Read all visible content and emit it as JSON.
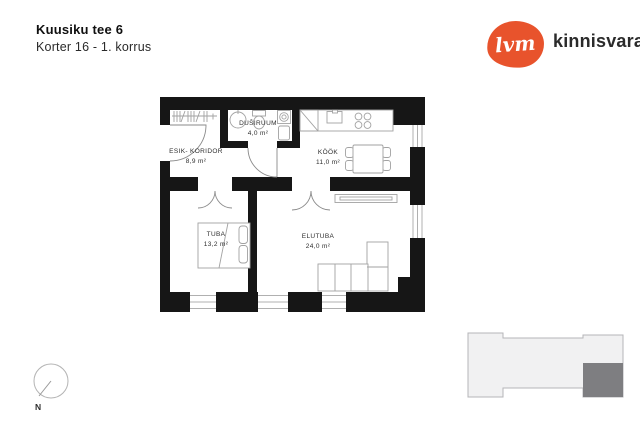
{
  "header": {
    "title": "Kuusiku tee 6",
    "subtitle": "Korter 16 - 1. korrus"
  },
  "logo": {
    "mark": "lvm",
    "brand": "kinnisvara",
    "color": "#e8532c"
  },
  "floor_plan": {
    "rooms": [
      {
        "name": "ESIK- KORIDOR",
        "area": "8,9 m²"
      },
      {
        "name": "DUŠIRUUM",
        "area": "4,0 m²"
      },
      {
        "name": "KÖÖK",
        "area": "11,0 m²"
      },
      {
        "name": "TUBA",
        "area": "13,2 m²"
      },
      {
        "name": "ELUTUBA",
        "area": "24,0 m²"
      }
    ],
    "fixtures": [
      "wardrobe",
      "washbasin",
      "toilet",
      "washing-machine",
      "boiler",
      "kitchen-counter",
      "kitchen-sink",
      "stove",
      "dining-table",
      "chair",
      "radiator",
      "double-bed",
      "corner-sofa",
      "entry-door",
      "interior-door",
      "window"
    ],
    "colors": {
      "wall": "#161616",
      "furniture_line": "#a2a2a2",
      "window_line": "#b0b0b0",
      "door_line": "#8a8a8a"
    }
  },
  "compass": {
    "label": "N"
  },
  "site_plan": {
    "building_fill": "#f1f1f2",
    "outline": "#b5b5b8",
    "apartment_highlight": "#7e7e81"
  }
}
